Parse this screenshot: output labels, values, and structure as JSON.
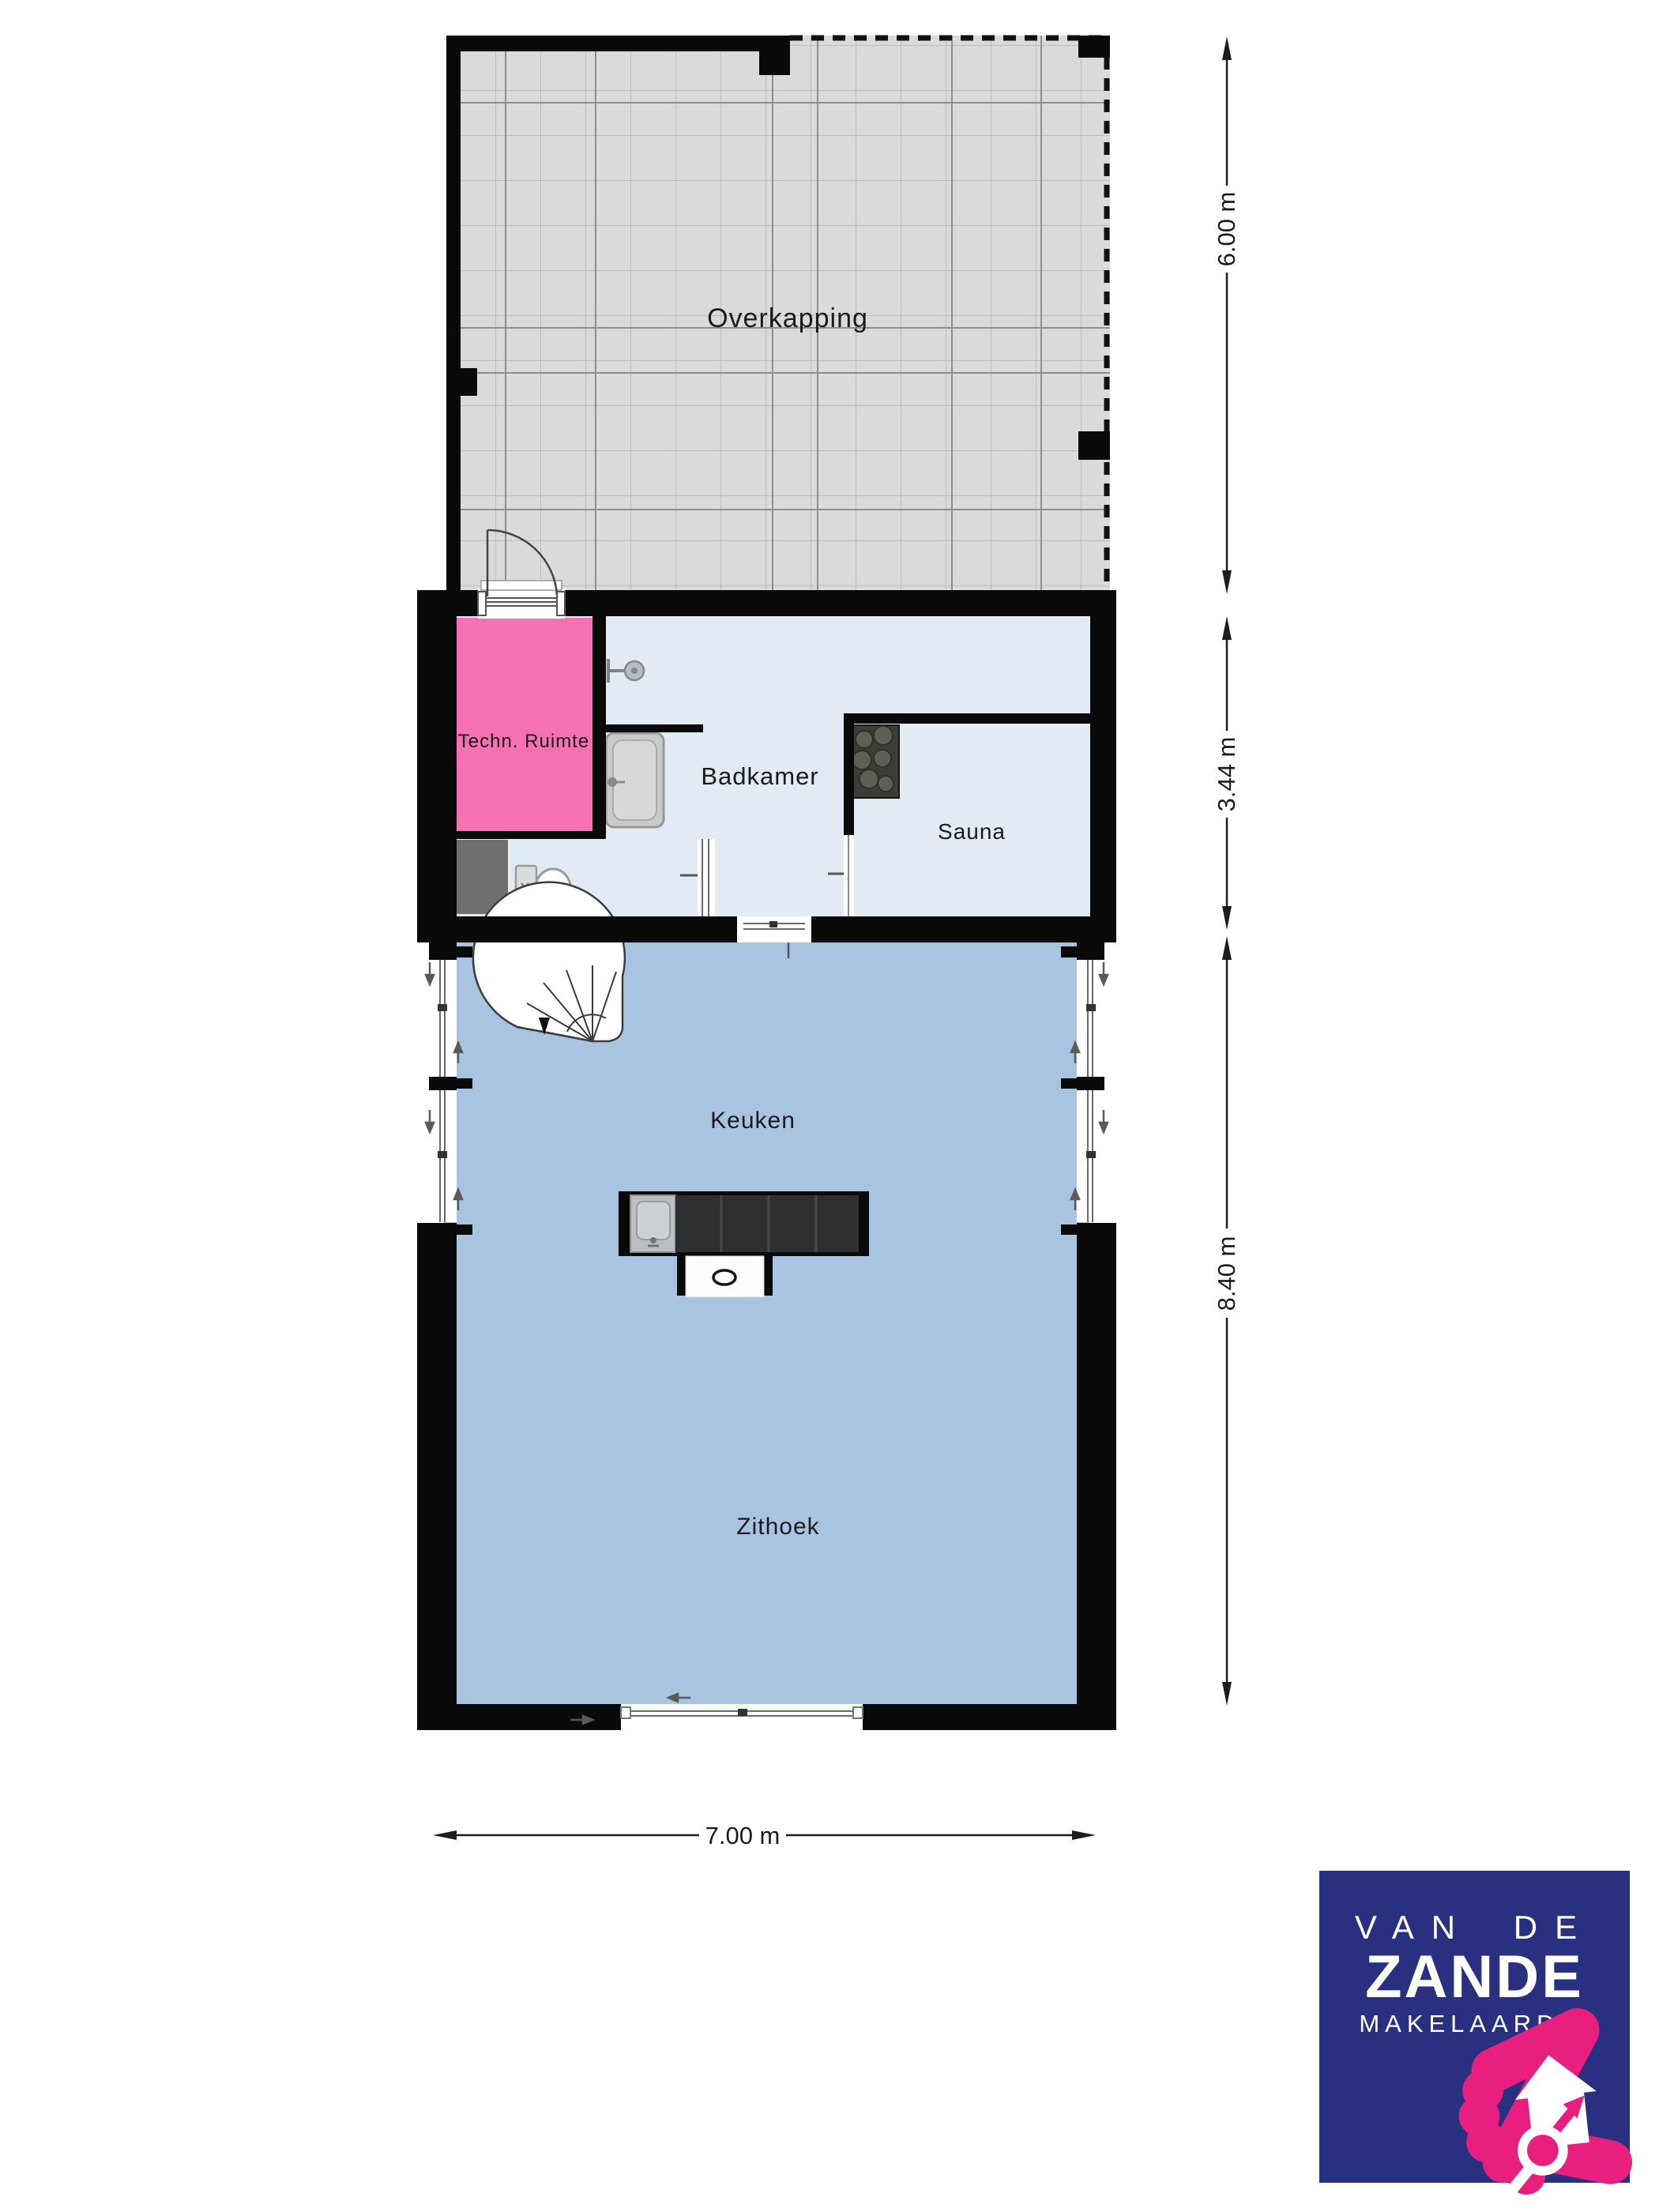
{
  "rooms": {
    "overkapping": {
      "label": "Overkapping"
    },
    "techn_ruimte": {
      "label": "Techn. Ruimte"
    },
    "badkamer": {
      "label": "Badkamer"
    },
    "sauna": {
      "label": "Sauna"
    },
    "keuken": {
      "label": "Keuken"
    },
    "zithoek": {
      "label": "Zithoek"
    }
  },
  "dimensions": {
    "overkapping_depth": "6.00 m",
    "top_section_depth": "3.44 m",
    "living_section_depth": "8.40 m",
    "total_width": "7.00 m"
  },
  "logo": {
    "line1": "VAN DE",
    "line2": "ZANDE",
    "line3": "MAKELAARDIJ"
  },
  "colors": {
    "wall": "#0a0a0a",
    "living_floor": "#a9c4e1",
    "wet_floor": "#e2eaf4",
    "techn_room": "#f571b3",
    "overkapping_floor": "#dadada",
    "logo_navy": "#2a3080",
    "logo_pink": "#e81f7e"
  }
}
